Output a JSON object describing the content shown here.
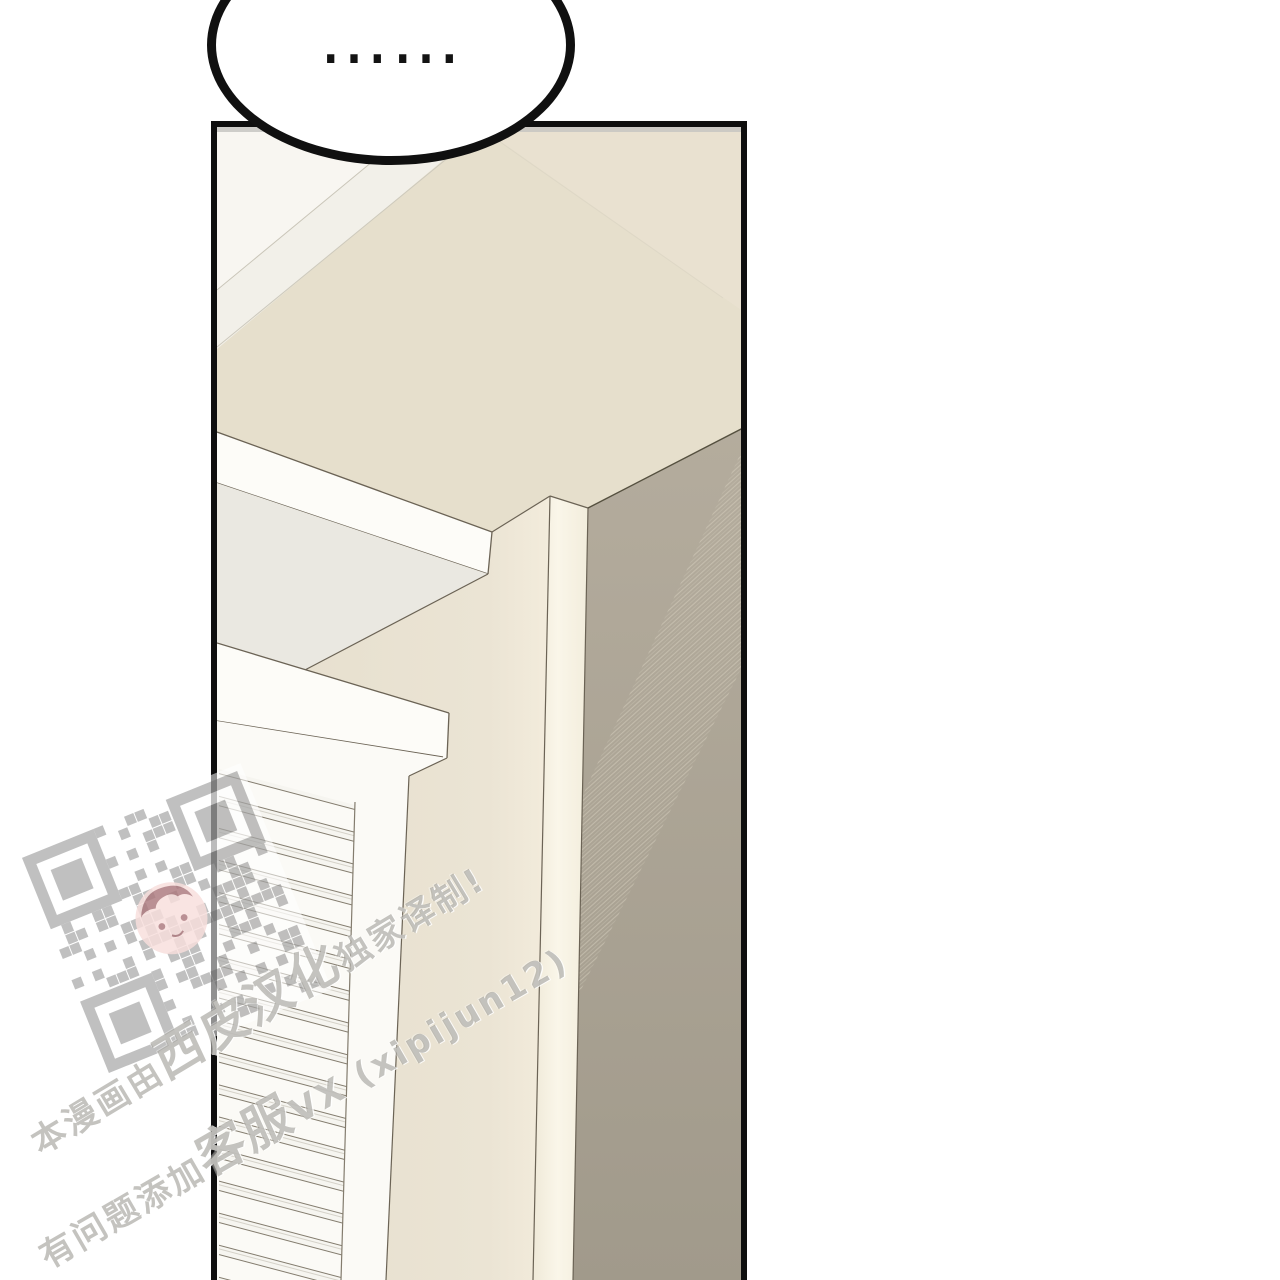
{
  "speech_bubble": {
    "text": "……"
  },
  "watermark": {
    "line1": {
      "prefix": "本漫画由",
      "group": "西皮汉化",
      "suffix": "独家译制!"
    },
    "line2": {
      "prefix": "有问题添加",
      "group": "客服",
      "suffix": "VX (xipijun12)"
    },
    "qr": {
      "label": "qr-code"
    }
  },
  "panel": {
    "colors": {
      "border": "#0e0e0e",
      "top_strip": "#c7c6c2",
      "ceiling": "#e6dfcc",
      "ceiling_light": "#f8f6f1",
      "ceiling_mid": "#f2f0e9",
      "beam": "#fdfcf8",
      "beam_shadow": "#eae8e1",
      "wall_front": "#e7e0cf",
      "wall_front_glow": "#f3ecdc",
      "column": "#f8f4e6",
      "wall_right_top": "#b4ac9d",
      "wall_right_bottom": "#a19a8b",
      "window": "#fbfaf6",
      "outline": "#6b6355"
    }
  }
}
